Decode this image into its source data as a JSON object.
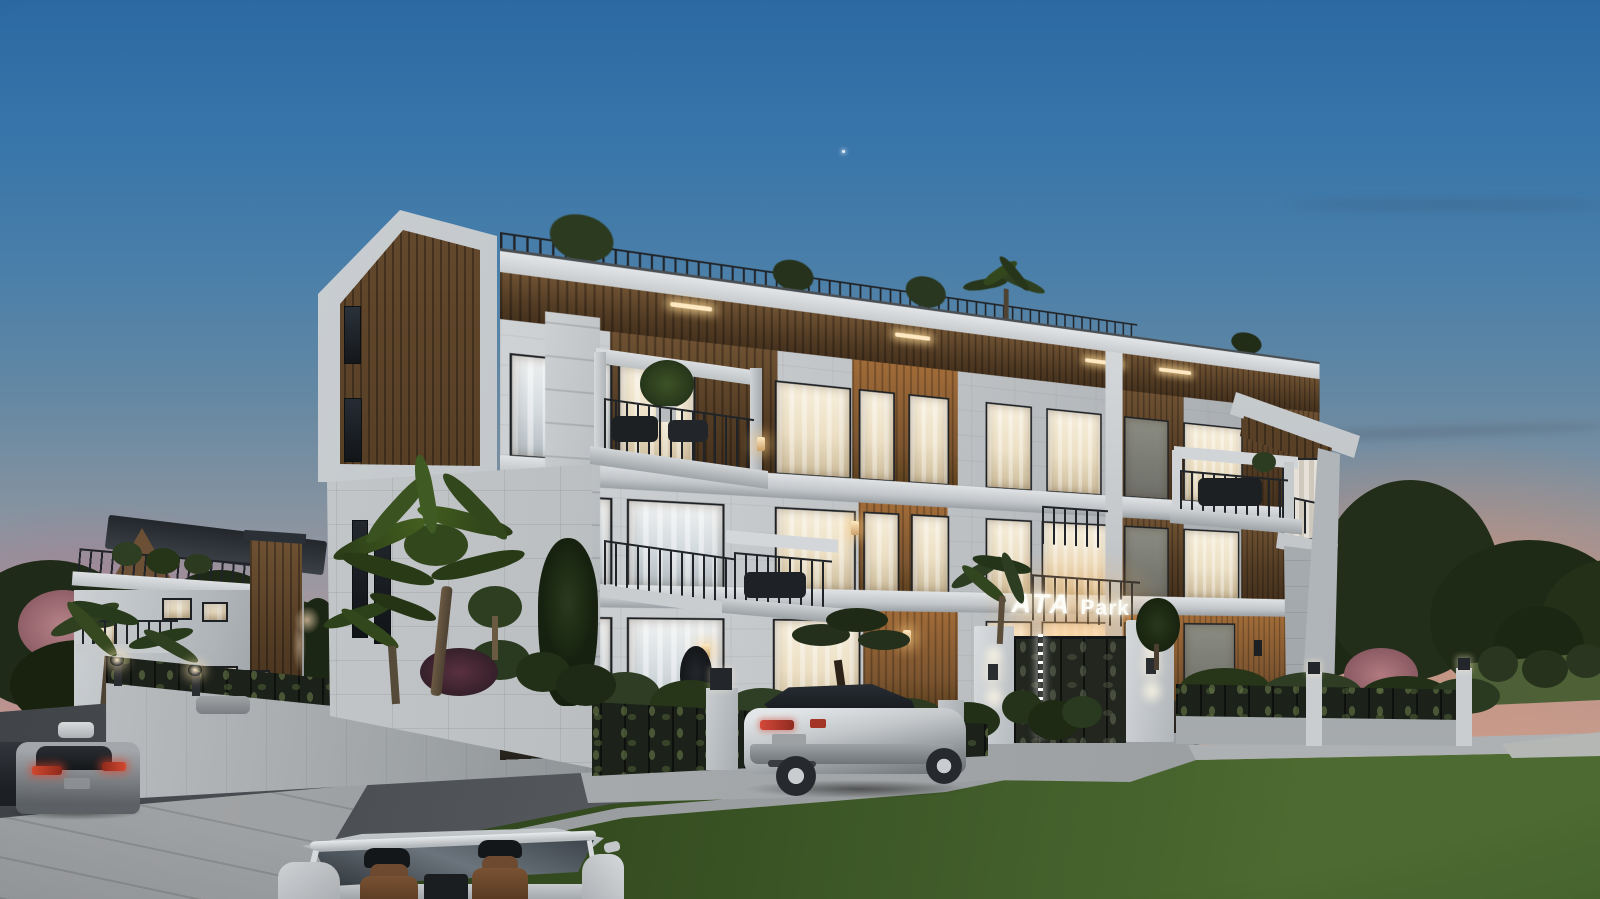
{
  "scene": {
    "type": "architectural dusk rendering",
    "sign": {
      "brand": "ATA",
      "suffix": "Park"
    },
    "objects": [
      "three-story modern apartment building with wood slat cladding",
      "illuminated ATA Park entrance sign over decorative metal gate",
      "perimeter wall with laser-cut lattice fence panels and hedges",
      "rooftop terrace railing with palm and plants",
      "balconies with outdoor furniture and potted trees",
      "silver SUV parked at curb",
      "white convertible with brown leather seats in foreground",
      "gray coupe and dark sedan on left street",
      "secondary villa with pitched dark roof on the left",
      "front lawn, palm trees, cypress and pink blossom trees",
      "twilight sky with pink-orange sunset glow"
    ],
    "colors": {
      "sky_top": "#2c69a2",
      "sky_lavender": "#9f98a0",
      "horizon_pink": "#cf9c88",
      "horizon_mauve": "#a97e92",
      "facade_white": "#d5d8da",
      "facade_shadow": "#9aa0a6",
      "wood_cladding": "#5a4127",
      "wood_lit": "#a06b38",
      "window_warm": "#f7efdc",
      "window_cool": "#d3dade",
      "stone_tile": "#c6c9cb",
      "lattice_dark": "#1c211a",
      "hedge_green": "#2c3a22",
      "tree_green": "#26331d",
      "grass_green": "#4c6a31",
      "road_asphalt": "#54585c",
      "sidewalk_concrete": "#a8abad",
      "wall_concrete": "#b6b9bb",
      "car_silver": "#c8cccf",
      "taillight_red": "#c23a2c",
      "sign_white": "#fdfdf8",
      "sconce_warm": "#caa06a"
    }
  }
}
